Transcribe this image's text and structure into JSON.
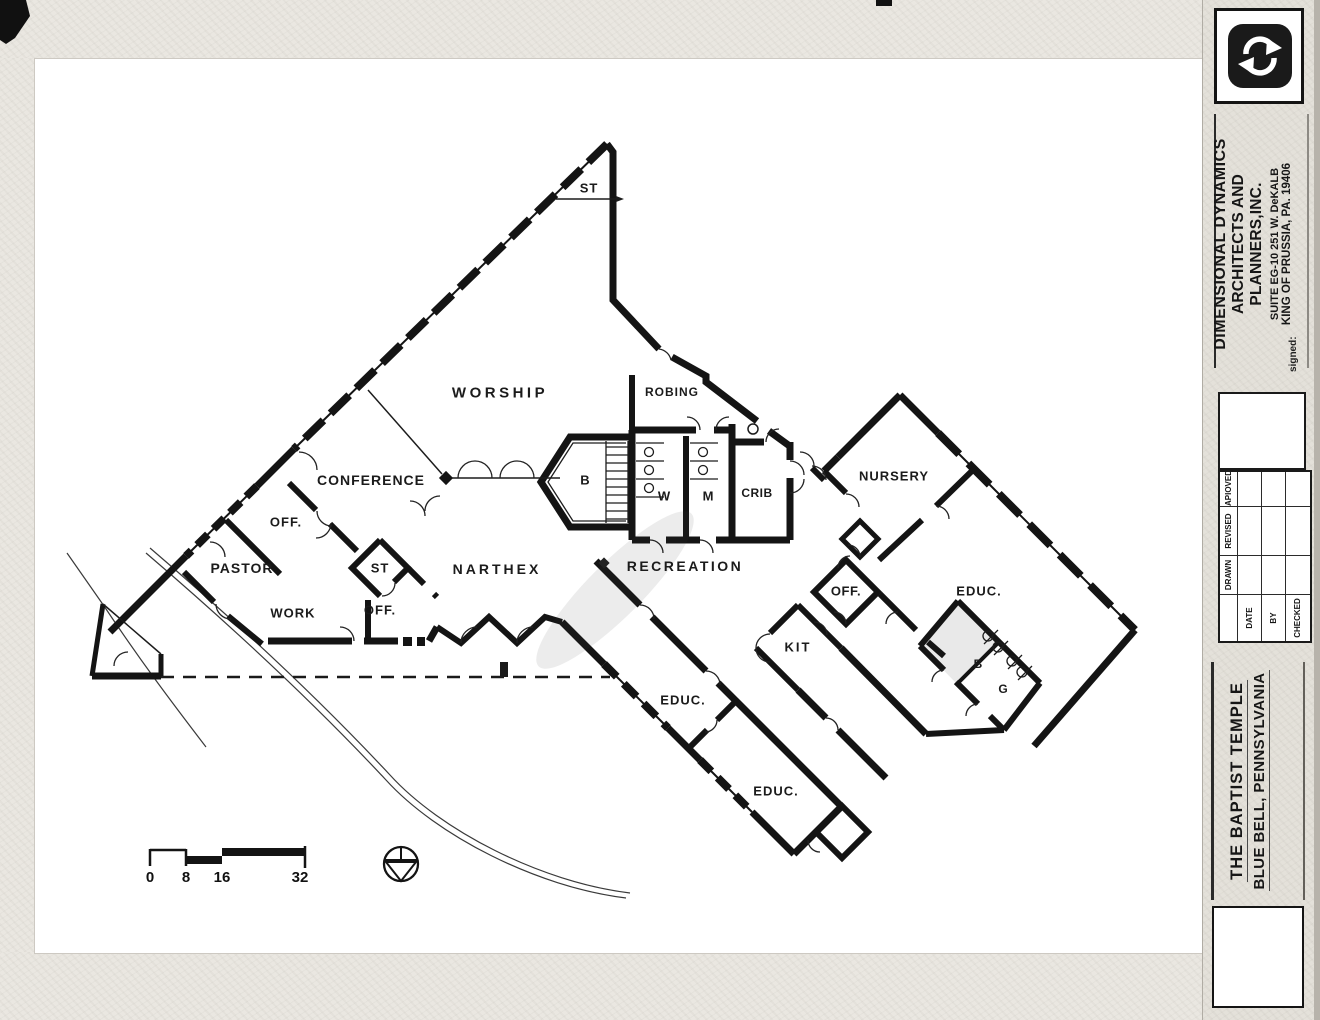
{
  "colors": {
    "ink": "#141414",
    "paper": "#ffffff",
    "margin_gray": "#eae7e1",
    "column_gray": "#e4e1da"
  },
  "plan": {
    "labels": [
      {
        "text": "ST",
        "x": 589,
        "y": 188,
        "size": 13,
        "ls": 1
      },
      {
        "text": "WORSHIP",
        "x": 500,
        "y": 393,
        "size": 15,
        "ls": 3.5
      },
      {
        "text": "ROBING",
        "x": 672,
        "y": 392,
        "size": 12,
        "ls": 1
      },
      {
        "text": "CONFERENCE",
        "x": 371,
        "y": 480,
        "size": 14,
        "ls": 1
      },
      {
        "text": "OFF.",
        "x": 286,
        "y": 522,
        "size": 13,
        "ls": 1
      },
      {
        "text": "PASTOR",
        "x": 242,
        "y": 568,
        "size": 14,
        "ls": 1
      },
      {
        "text": "WORK",
        "x": 293,
        "y": 613,
        "size": 13,
        "ls": 1
      },
      {
        "text": "ST",
        "x": 380,
        "y": 568,
        "size": 13,
        "ls": 1
      },
      {
        "text": "OFF.",
        "x": 380,
        "y": 610,
        "size": 13,
        "ls": 1
      },
      {
        "text": "NARTHEX",
        "x": 497,
        "y": 569,
        "size": 14,
        "ls": 3
      },
      {
        "text": "B",
        "x": 585,
        "y": 480,
        "size": 13,
        "ls": 0
      },
      {
        "text": "W",
        "x": 664,
        "y": 496,
        "size": 13,
        "ls": 0
      },
      {
        "text": "M",
        "x": 708,
        "y": 496,
        "size": 13,
        "ls": 0
      },
      {
        "text": "CRIB",
        "x": 757,
        "y": 493,
        "size": 12,
        "ls": 0.5
      },
      {
        "text": "RECREATION",
        "x": 685,
        "y": 566,
        "size": 14,
        "ls": 2.5
      },
      {
        "text": "NURSERY",
        "x": 894,
        "y": 476,
        "size": 13,
        "ls": 1
      },
      {
        "text": "OFF.",
        "x": 846,
        "y": 591,
        "size": 13,
        "ls": 0.5
      },
      {
        "text": "KIT",
        "x": 798,
        "y": 647,
        "size": 13,
        "ls": 2
      },
      {
        "text": "EDUC.",
        "x": 979,
        "y": 591,
        "size": 13,
        "ls": 1
      },
      {
        "text": "B",
        "x": 978,
        "y": 664,
        "size": 12,
        "ls": 0
      },
      {
        "text": "G",
        "x": 1003,
        "y": 689,
        "size": 12,
        "ls": 0
      },
      {
        "text": "EDUC.",
        "x": 683,
        "y": 700,
        "size": 13,
        "ls": 1
      },
      {
        "text": "EDUC.",
        "x": 776,
        "y": 791,
        "size": 13,
        "ls": 1
      }
    ],
    "scale_bar": {
      "ticks": [
        "0",
        "8",
        "16",
        "32"
      ]
    }
  },
  "title_block": {
    "firm": {
      "line1": "DIMENSIONAL DYNAMICS",
      "line2": "ARCHITECTS AND PLANNERS,INC.",
      "line3": "SUITE EG-10   251 W. DeKALB",
      "line4": "KING OF PRUSSIA, PA. 19406",
      "signed": "signed:"
    },
    "revision": {
      "columns": [
        "DRAWN",
        "REVISED",
        "APIOVED"
      ],
      "rows": [
        "DATE",
        "BY",
        "CHECKED"
      ]
    },
    "project": {
      "line1": "THE BAPTIST  TEMPLE",
      "line2": "BLUE BELL, PENNSYLVANIA"
    }
  }
}
